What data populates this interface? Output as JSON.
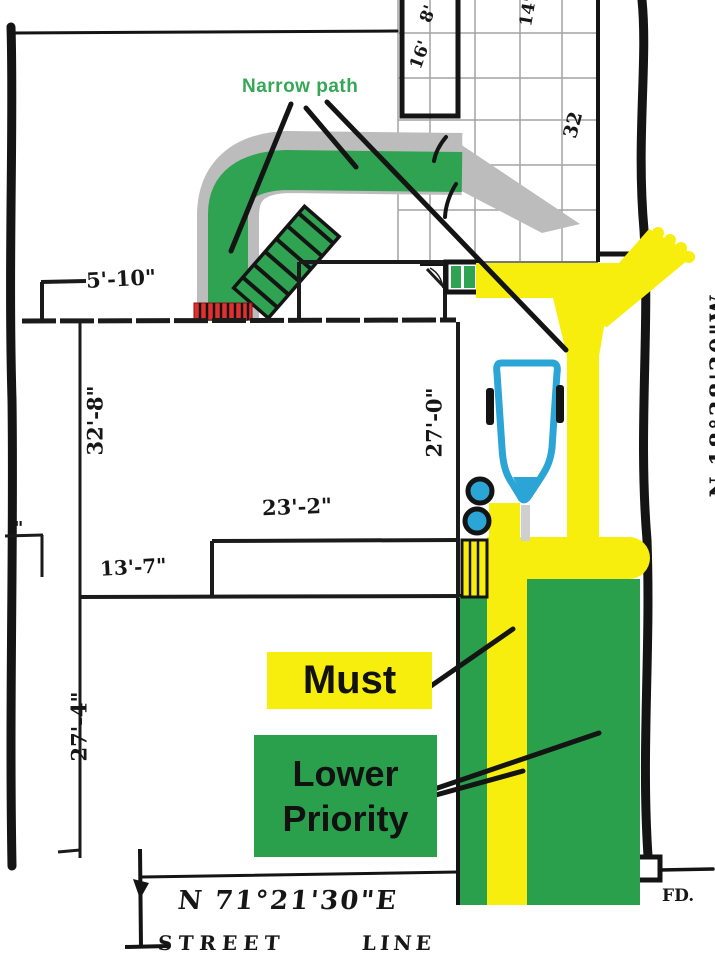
{
  "labels": {
    "narrow_path": "Narrow path",
    "must": "Must",
    "lower": "Lower",
    "priority": "Priority"
  },
  "dimensions": {
    "front_setback": "5'-10\"",
    "house_side_left": "32'-8\"",
    "house_side_right": "27'-0\"",
    "house_rear_width": "23'-2\"",
    "house_rear_offset": "13'-7\"",
    "rear_yard_left": "27'-4\"",
    "patio_cell_a": "8'",
    "patio_cell_b": "16'",
    "patio_top": "14'",
    "patio_length": "32",
    "left_tick": "\""
  },
  "bearings": {
    "side_lot_line": "N.18°38'30\"W",
    "street_line": "N 71°21'30\"E"
  },
  "street": {
    "street_word": "STREET",
    "line_word": "LINE"
  },
  "survey_marks": {
    "found_drill_hole": "FD."
  },
  "colors": {
    "path_green": "#2fa351",
    "wide_path_gray": "#bcbcbc",
    "highlight_yellow": "#f8ee0e",
    "priority_green": "#2aa04c",
    "steps_red": "#e03131",
    "object_blue": "#2aa5d6",
    "ink_black": "#161616"
  }
}
